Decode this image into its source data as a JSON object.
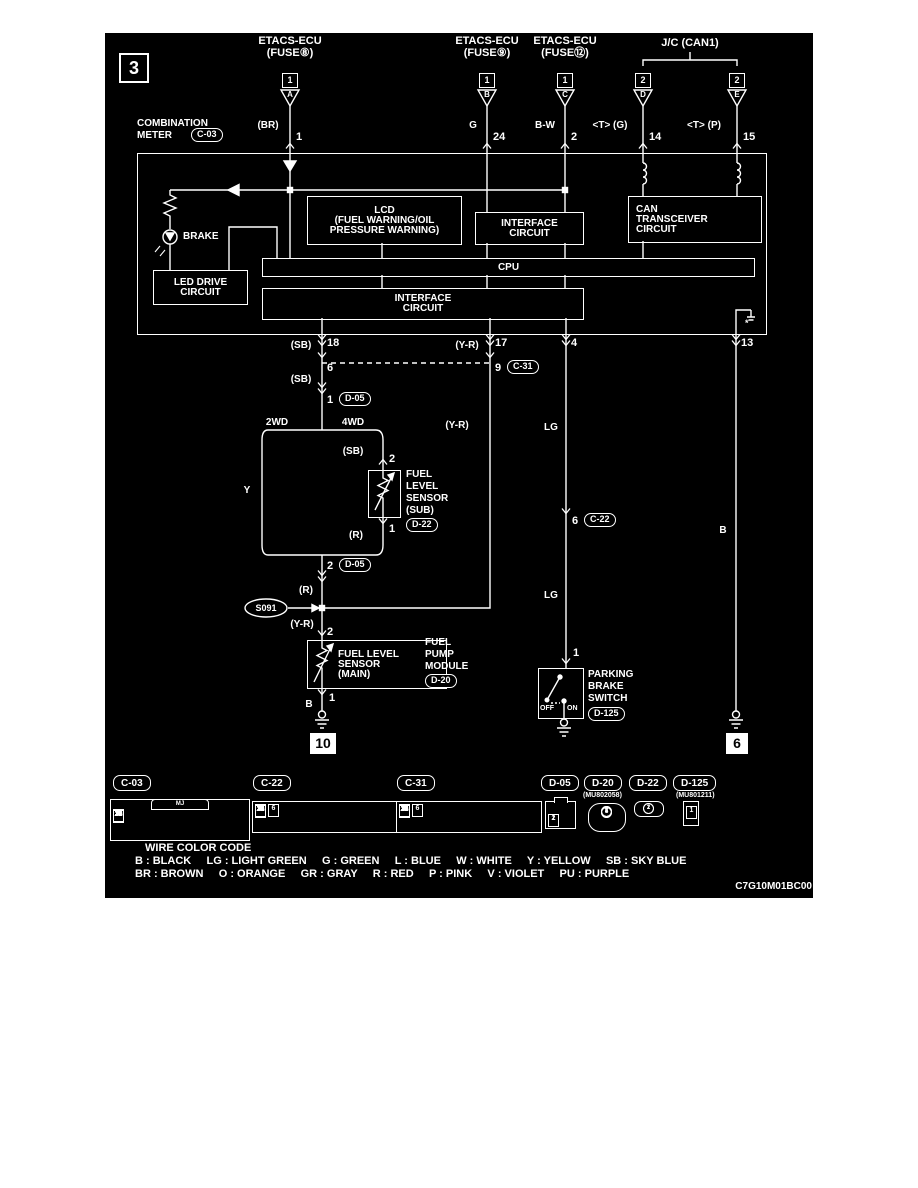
{
  "page": {
    "badge": "3",
    "diagram_code": "C7G10M01BC00"
  },
  "header": {
    "sources": [
      {
        "name": "ETACS-ECU",
        "fuse": "(FUSE⑧)",
        "box": "1",
        "terminal": "A",
        "wire": "(BR)",
        "pin": "1"
      },
      {
        "name": "ETACS-ECU",
        "fuse": "(FUSE⑨)",
        "box": "1",
        "terminal": "B",
        "wire": "G",
        "pin": "24"
      },
      {
        "name": "ETACS-ECU",
        "fuse": "(FUSE⑫)",
        "box": "1",
        "terminal": "C",
        "wire": "B-W",
        "pin": "2"
      }
    ],
    "junction": {
      "label": "J/C (CAN1)",
      "branches": [
        {
          "box": "2",
          "terminal": "D",
          "wire": "<T> (G)",
          "pin": "14"
        },
        {
          "box": "2",
          "terminal": "E",
          "wire": "<T> (P)",
          "pin": "15"
        }
      ]
    }
  },
  "meter": {
    "name_line1": "COMBINATION",
    "name_line2": "METER",
    "connector": "C-03",
    "brake": "BRAKE",
    "led_drive_line1": "LED DRIVE",
    "led_drive_line2": "CIRCUIT",
    "lcd_line1": "LCD",
    "lcd_line2": "(FUEL WARNING/OIL",
    "lcd_line3": "PRESSURE WARNING)",
    "if1_line1": "INTERFACE",
    "if1_line2": "CIRCUIT",
    "can_line1": "CAN",
    "can_line2": "TRANSCEIVER",
    "can_line3": "CIRCUIT",
    "cpu": "CPU",
    "if2_line1": "INTERFACE",
    "if2_line2": "CIRCUIT",
    "note": "*",
    "pins": {
      "p18": {
        "wire": "(SB)",
        "num": "18"
      },
      "p17": {
        "wire": "(Y-R)",
        "num": "17"
      },
      "p4": {
        "num": "4"
      },
      "p13": {
        "num": "13"
      }
    }
  },
  "left": {
    "sb2": "(SB)",
    "p6": "6",
    "sb3": "(SB)",
    "p1": "1",
    "d05a": "D-05",
    "c31": {
      "pin": "9",
      "label": "C-31"
    },
    "yr2": "(Y-R)",
    "split": {
      "left": "2WD",
      "right": "4WD",
      "wire_y": "Y"
    },
    "sub": {
      "wire_sb": "(SB)",
      "pin_top": "2",
      "line1": "FUEL",
      "line2": "LEVEL",
      "line3": "SENSOR",
      "line4": "(SUB)",
      "connector": "D-22",
      "pin_bot": "1",
      "wire_r": "(R)"
    },
    "merge": {
      "pin": "2",
      "d05": "D-05",
      "wire_r": "(R)"
    },
    "splice": {
      "label": "S091",
      "wire_yr": "(Y-R)",
      "pin": "2"
    },
    "main": {
      "line1": "FUEL LEVEL",
      "line2": "SENSOR",
      "line3": "(MAIN)",
      "mod1": "FUEL",
      "mod2": "PUMP",
      "mod3": "MODULE",
      "connector": "D-20",
      "pin_bot": "1",
      "wire_b": "B",
      "ground": "10"
    }
  },
  "middle": {
    "lg1": "LG",
    "c22": {
      "pin": "6",
      "label": "C-22"
    },
    "lg2": "LG",
    "pin1": "1",
    "switch": {
      "line1": "PARKING",
      "line2": "BRAKE",
      "line3": "SWITCH",
      "connector": "D-125",
      "off": "OFF",
      "on": "ON"
    }
  },
  "right": {
    "wire_b": "B",
    "ground": "6"
  },
  "connectors": {
    "c03": {
      "label": "C-03",
      "tag": "MJ",
      "rows": [
        [
          "1",
          "2",
          "3",
          "4",
          "5",
          "6",
          "7",
          "8",
          "9",
          "10",
          "11",
          "12"
        ],
        [
          "13",
          "14",
          "15",
          "16",
          "17",
          "18",
          "19",
          "20",
          "21",
          "22",
          "23",
          "24"
        ]
      ]
    },
    "c22": {
      "label": "C-22",
      "rows": [
        [
          "1",
          "2",
          "3",
          "4",
          "5",
          "6",
          "7",
          "8",
          "9",
          "10",
          "11"
        ],
        [
          "12",
          "13",
          "14",
          "15",
          "16",
          "17",
          "18",
          "19",
          "20",
          "21",
          "22",
          "23",
          "24"
        ]
      ]
    },
    "c31": {
      "label": "C-31",
      "rows": [
        [
          "1",
          "2",
          "3",
          "4",
          "5",
          "6",
          "7",
          "8",
          "9",
          "10",
          "11"
        ],
        [
          "12",
          "13",
          "14",
          "15",
          "16",
          "17",
          "18",
          "19",
          "20",
          "21",
          "22",
          "23",
          "24"
        ]
      ]
    },
    "d05": {
      "label": "D-05",
      "rows": [
        [
          "1",
          "2"
        ]
      ]
    },
    "d20": {
      "label": "D-20",
      "part": "(MU802058)",
      "rows": [
        [
          "1",
          "2",
          "3"
        ],
        [
          "4",
          "5"
        ]
      ]
    },
    "d22": {
      "label": "D-22",
      "rows": [
        [
          "1",
          "2"
        ]
      ]
    },
    "d125": {
      "label": "D-125",
      "part": "(MU801211)",
      "rows": [
        [
          "1"
        ]
      ]
    }
  },
  "legend": {
    "title": "WIRE COLOR CODE",
    "line1": "B : BLACK     LG : LIGHT GREEN     G : GREEN     L : BLUE     W : WHITE     Y : YELLOW     SB : SKY BLUE",
    "line2": "BR : BROWN     O : ORANGE     GR : GRAY     R : RED     P : PINK     V : VIOLET     PU : PURPLE"
  }
}
